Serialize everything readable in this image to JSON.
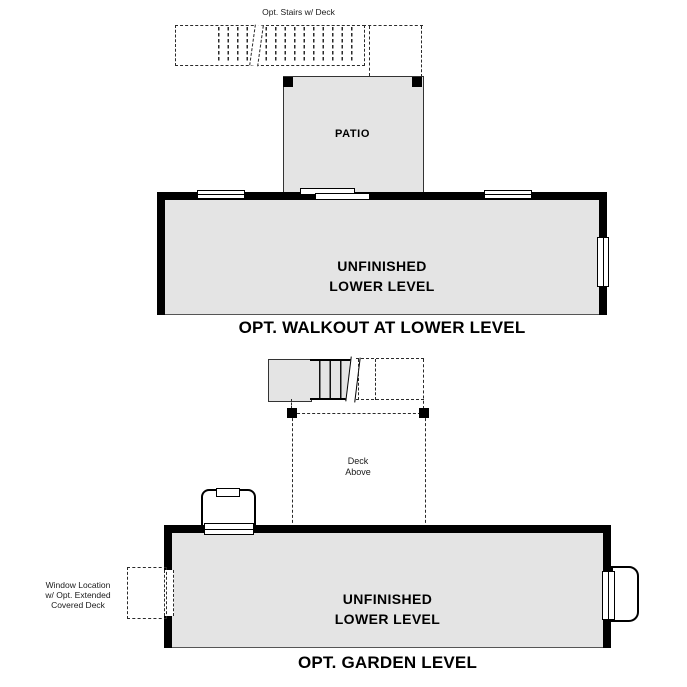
{
  "colors": {
    "room_fill": "#e4e4e4",
    "wall": "#000000",
    "line": "#2a2a2a"
  },
  "walkout": {
    "stairs_label": "Opt. Stairs w/ Deck",
    "patio_label": "PATIO",
    "room_label_line1": "UNFINISHED",
    "room_label_line2": "LOWER LEVEL",
    "title": "OPT. WALKOUT AT LOWER LEVEL"
  },
  "garden": {
    "deck_label_line1": "Deck",
    "deck_label_line2": "Above",
    "room_label_line1": "UNFINISHED",
    "room_label_line2": "LOWER LEVEL",
    "window_note": [
      "Window Location",
      "w/ Opt. Extended",
      "Covered Deck"
    ],
    "title": "OPT. GARDEN LEVEL"
  }
}
